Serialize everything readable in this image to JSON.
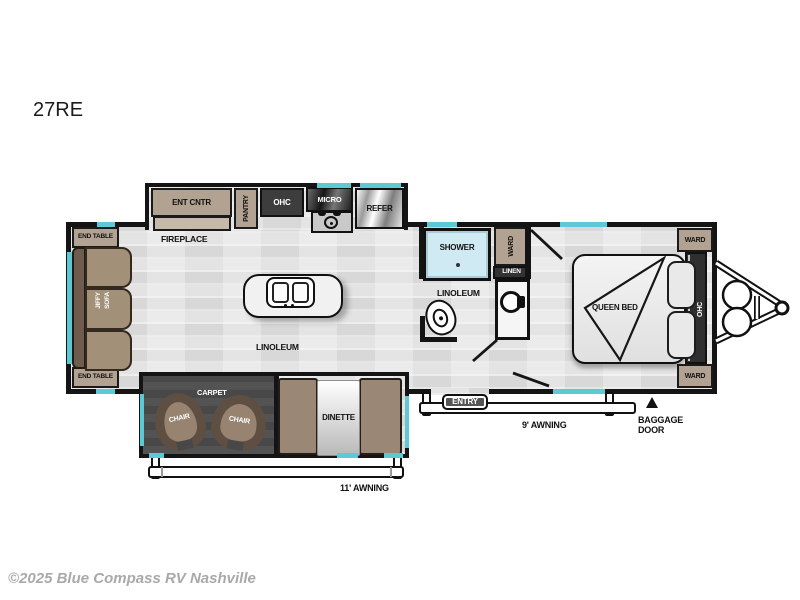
{
  "page": {
    "title": "27RE",
    "copyright": "©2025 Blue Compass RV Nashville"
  },
  "labels": {
    "ent_cntr": "ENT CNTR",
    "pantry": "PANTRY",
    "ohc": "OHC",
    "micro": "MICRO",
    "refer": "REFER",
    "fireplace": "FIREPLACE",
    "end_table": "END TABLE",
    "jiffy": "JIFFY",
    "sofa": "SOFA",
    "linoleum": "LINOLEUM",
    "shower": "SHOWER",
    "ward": "WARD",
    "linen": "LINEN",
    "queen_bed": "QUEEN BED",
    "carpet": "CARPET",
    "chair": "CHAIR",
    "dinette": "DINETTE",
    "entry": "ENTRY",
    "awning_11": "11' AWNING",
    "awning_9": "9' AWNING",
    "baggage_line1": "BAGGAGE",
    "baggage_line2": "DOOR"
  },
  "colors": {
    "wall": "#141414",
    "accent_teal": "#5cc9d5",
    "cabinet_tan": "#b2a292",
    "cabinet_tan_light": "#c7b9a9",
    "wood_brown": "#9a8775",
    "wood_brown_dark": "#6e5d4e",
    "slide_floor_dark": "#484848",
    "dark_fixture": "#3d3d3d",
    "shower_blue": "#cfeaf2",
    "floor_gray": "#e3e3e3",
    "watermark_gray": "#a9a9a9"
  }
}
